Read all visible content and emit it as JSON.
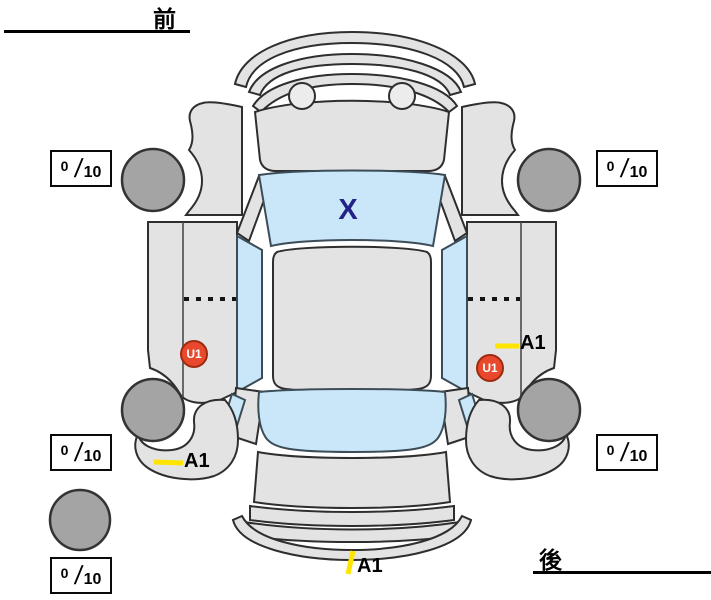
{
  "labels": {
    "front": "前",
    "rear": "後"
  },
  "windshield_marker": {
    "text": "X",
    "color": "#232287",
    "meaning": "glass-damage-mark"
  },
  "tread_boxes": [
    {
      "id": "front-left",
      "value": "0",
      "sep": "/",
      "max": "10"
    },
    {
      "id": "front-right",
      "value": "0",
      "sep": "/",
      "max": "10"
    },
    {
      "id": "rear-left",
      "value": "0",
      "sep": "/",
      "max": "10"
    },
    {
      "id": "rear-right",
      "value": "0",
      "sep": "/",
      "max": "10"
    },
    {
      "id": "spare",
      "value": "0",
      "sep": "/",
      "max": "10"
    }
  ],
  "damage_markers": [
    {
      "id": "u1-left",
      "text": "U1",
      "badge_color": "#e8482c"
    },
    {
      "id": "u1-right",
      "text": "U1",
      "badge_color": "#e8482c"
    },
    {
      "id": "a1-right-side",
      "text": "A1",
      "tick_color": "#ffe400"
    },
    {
      "id": "a1-rear-left",
      "text": "A1",
      "tick_color": "#ffe400"
    },
    {
      "id": "a1-rear-center",
      "text": "A1",
      "tick_color": "#ffe400"
    }
  ],
  "colors": {
    "body": "#e3e3e3",
    "glass": "#c9e7f8",
    "tire": "#a4a4a4",
    "outline": "#2e2e2e",
    "marker_yellow": "#ffe400",
    "u1_red": "#e8482c",
    "x_blue": "#232287"
  }
}
